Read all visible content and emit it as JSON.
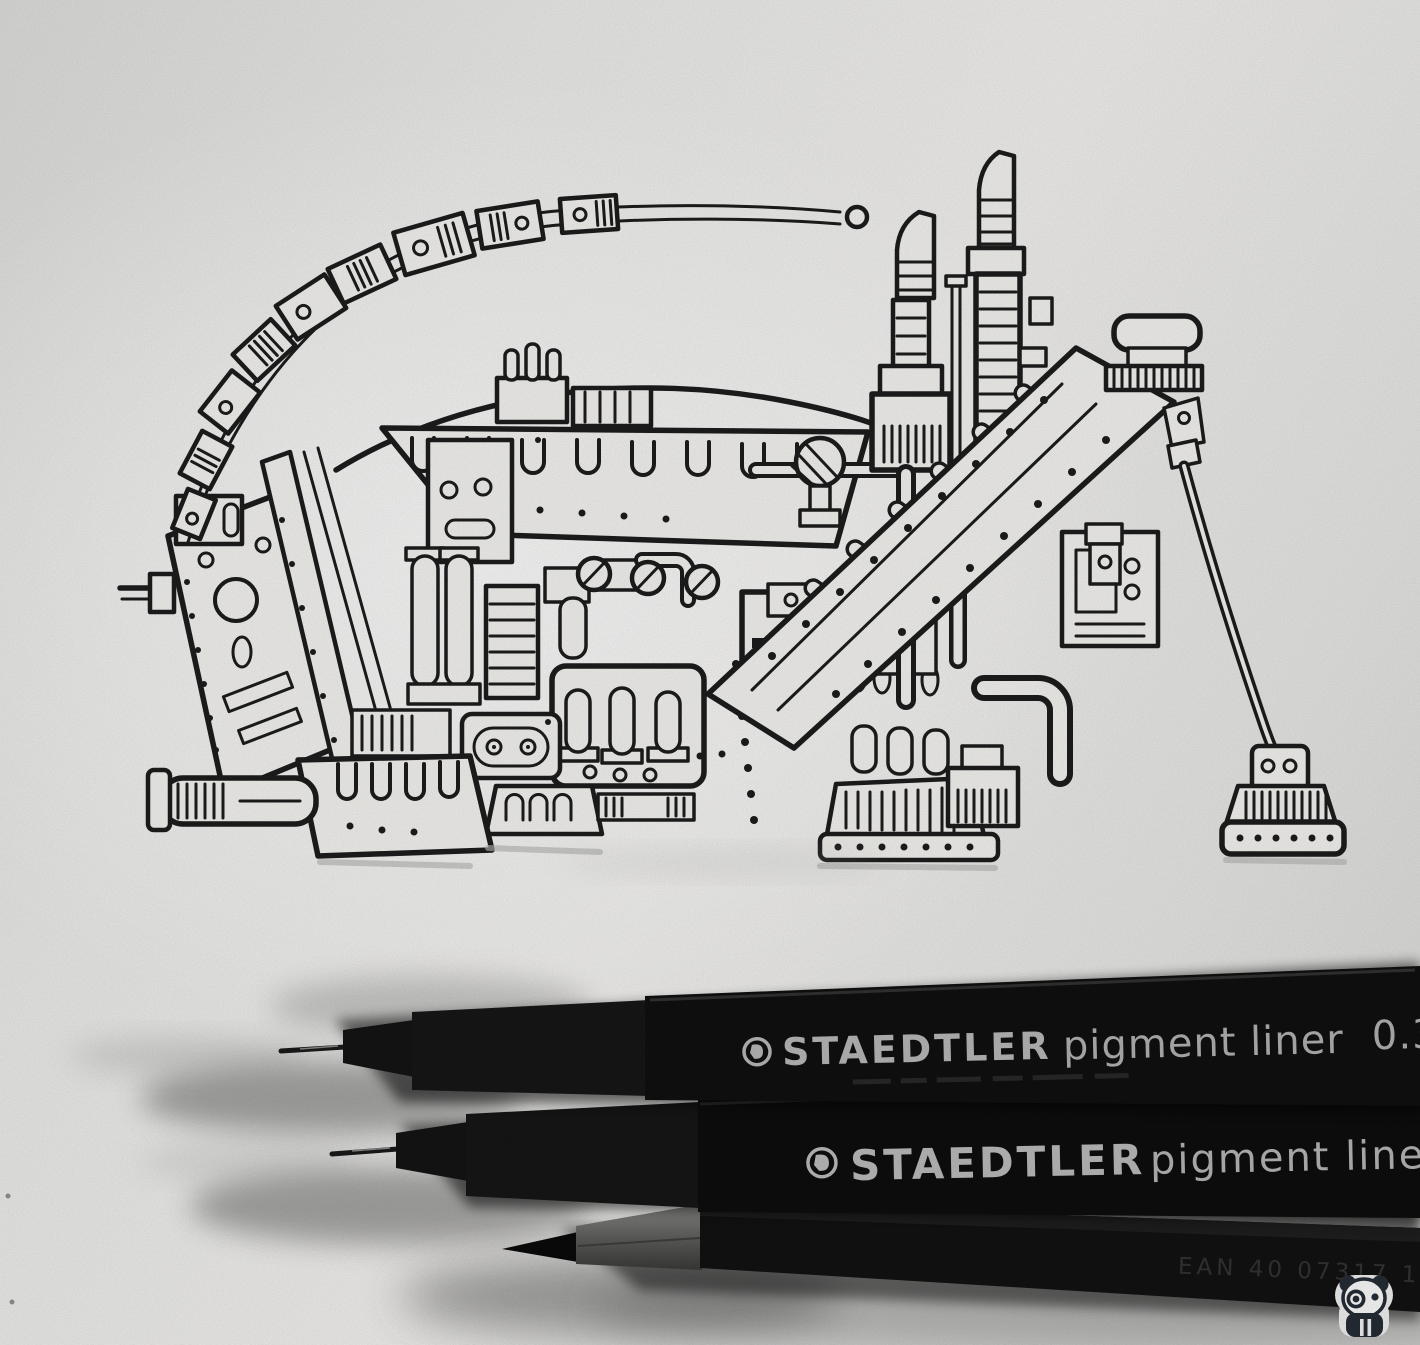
{
  "scene": {
    "type": "photograph",
    "subject": "Black fineliner ink doodle of a fantastical walking machine on white paper, with two fineliner pens and a sharpened pencil below",
    "paper_color": "#f3f2f0",
    "ink_color": "#1d1d1d"
  },
  "pens": {
    "pen_top": {
      "brand": "STAEDTLER",
      "product": "pigment liner",
      "size": "0.3",
      "body_color": "#101010",
      "print_color": "#b9b9b9"
    },
    "pen_bottom": {
      "brand": "STAEDTLER",
      "product": "pigment liner",
      "body_color": "#0d0d0d",
      "print_color": "#bcbcbc"
    },
    "pencil": {
      "embossed_text": "EAN 40 07317 101",
      "body_color": "#121212"
    }
  },
  "watermark": {
    "label": "panda-logo",
    "sticker_color": "#f2f2f2",
    "ink_color": "#262d36"
  }
}
